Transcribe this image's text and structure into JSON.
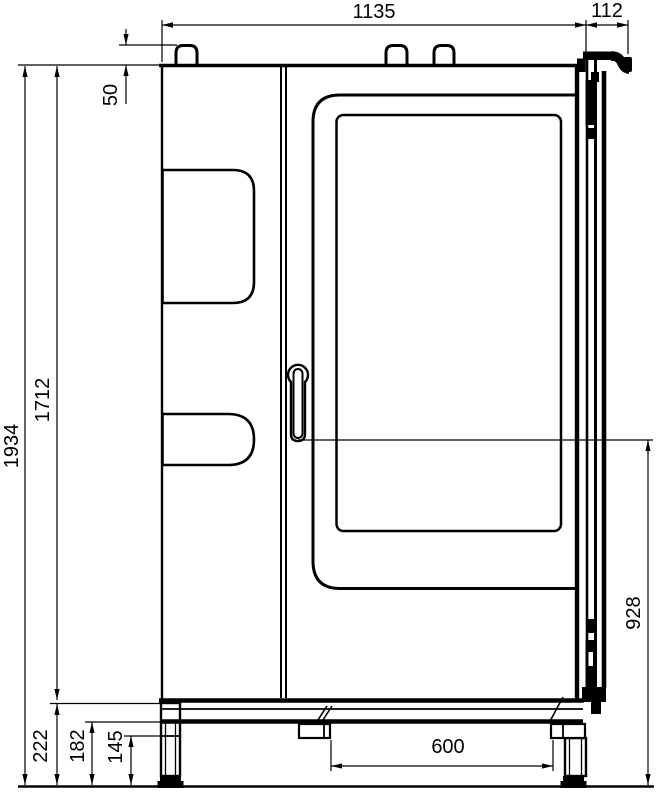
{
  "drawing": {
    "dimension_labels": {
      "width": "1135",
      "handle_offset": "112",
      "roof_fitting_height": "50",
      "overall_height": "1934",
      "body_height": "1712",
      "handle_height": "928",
      "plinth_height": "222",
      "frame_clearance": "182",
      "foot_height": "145",
      "stand_spacing": "600"
    },
    "style": {
      "line_color": "#000000",
      "background": "#ffffff"
    }
  }
}
